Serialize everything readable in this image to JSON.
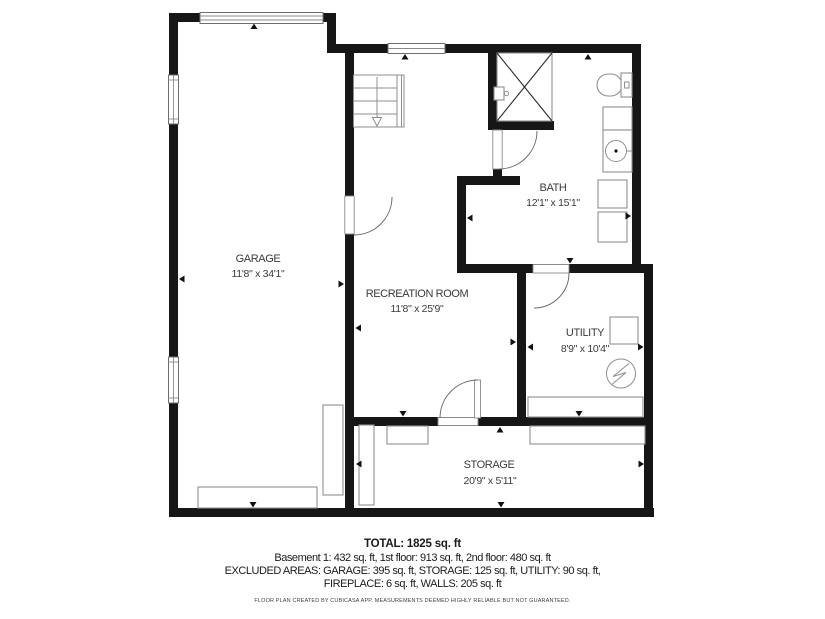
{
  "plan": {
    "rooms": [
      {
        "id": "garage",
        "name": "GARAGE",
        "dims": "11'8\" x 34'1\""
      },
      {
        "id": "recreation-room",
        "name": "RECREATION ROOM",
        "dims": "11'8\" x 25'9\""
      },
      {
        "id": "bath",
        "name": "BATH",
        "dims": "12'1\" x 15'1\""
      },
      {
        "id": "utility",
        "name": "UTILITY",
        "dims": "8'9\" x 10'4\""
      },
      {
        "id": "storage",
        "name": "STORAGE",
        "dims": "20'9\" x 5'11\""
      }
    ],
    "icons": [
      "stairs-down-icon",
      "shower-icon",
      "toilet-icon",
      "sink-icon",
      "water-heater-icon",
      "electrical-panel-icon",
      "garage-door-window",
      "window",
      "door-swing"
    ],
    "colors": {
      "wall": "#161616",
      "furniture_outline": "#8f8f8f",
      "label_text": "#3a3a3a",
      "background": "#ffffff"
    }
  },
  "summary": {
    "total": "TOTAL: 1825 sq. ft",
    "floors": "Basement 1: 432 sq. ft, 1st floor: 913 sq. ft, 2nd floor: 480 sq. ft",
    "excluded_line1": "EXCLUDED AREAS: GARAGE: 395 sq. ft, STORAGE: 125 sq. ft, UTILITY: 90 sq. ft,",
    "excluded_line2": "FIREPLACE: 6 sq. ft, WALLS: 205 sq. ft",
    "disclaimer": "FLOOR PLAN CREATED BY CUBICASA APP. MEASUREMENTS DEEMED HIGHLY RELIABLE BUT NOT GUARANTEED."
  }
}
